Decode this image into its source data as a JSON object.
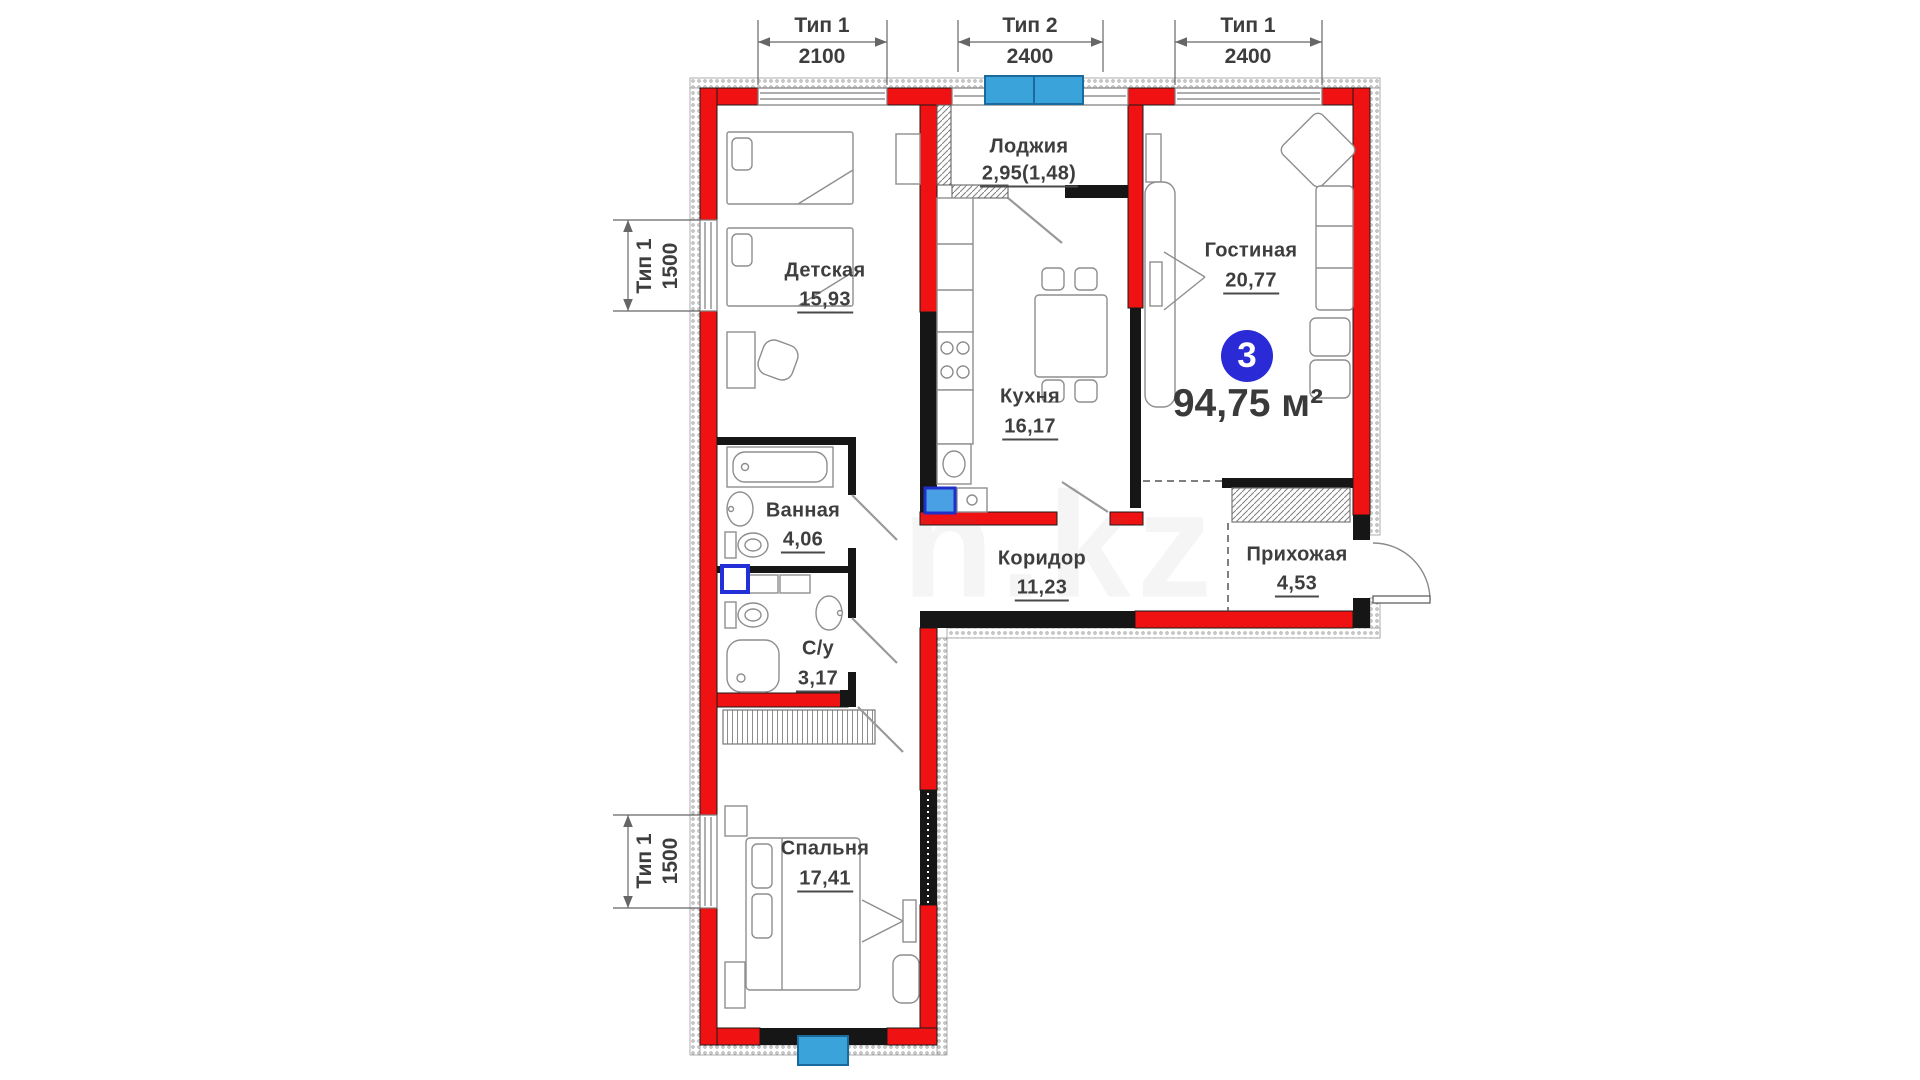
{
  "floor_plan": {
    "apartment": {
      "number": "3",
      "total_area": "94,75 м²"
    },
    "rooms": [
      {
        "name": "Лоджия",
        "area": "2,95(1,48)"
      },
      {
        "name": "Детская",
        "area": "15,93"
      },
      {
        "name": "Гостиная",
        "area": "20,77"
      },
      {
        "name": "Кухня",
        "area": "16,17"
      },
      {
        "name": "Ванная",
        "area": "4,06"
      },
      {
        "name": "Коридор",
        "area": "11,23"
      },
      {
        "name": "Прихожая",
        "area": "4,53"
      },
      {
        "name": "С/у",
        "area": "3,17"
      },
      {
        "name": "Спальня",
        "area": "17,41"
      }
    ],
    "window_dimensions": {
      "top": [
        {
          "type": "Тип 1",
          "width_mm": "2100"
        },
        {
          "type": "Тип 2",
          "width_mm": "2400"
        },
        {
          "type": "Тип 1",
          "width_mm": "2400"
        }
      ],
      "left": [
        {
          "type": "Тип 1",
          "width_mm": "1500"
        },
        {
          "type": "Тип 1",
          "width_mm": "1500"
        }
      ]
    },
    "colors": {
      "wall_red": "#f01212",
      "badge_blue": "#2a2ad6",
      "window_blue": "#3aa4da"
    },
    "watermark": "n.kz"
  }
}
